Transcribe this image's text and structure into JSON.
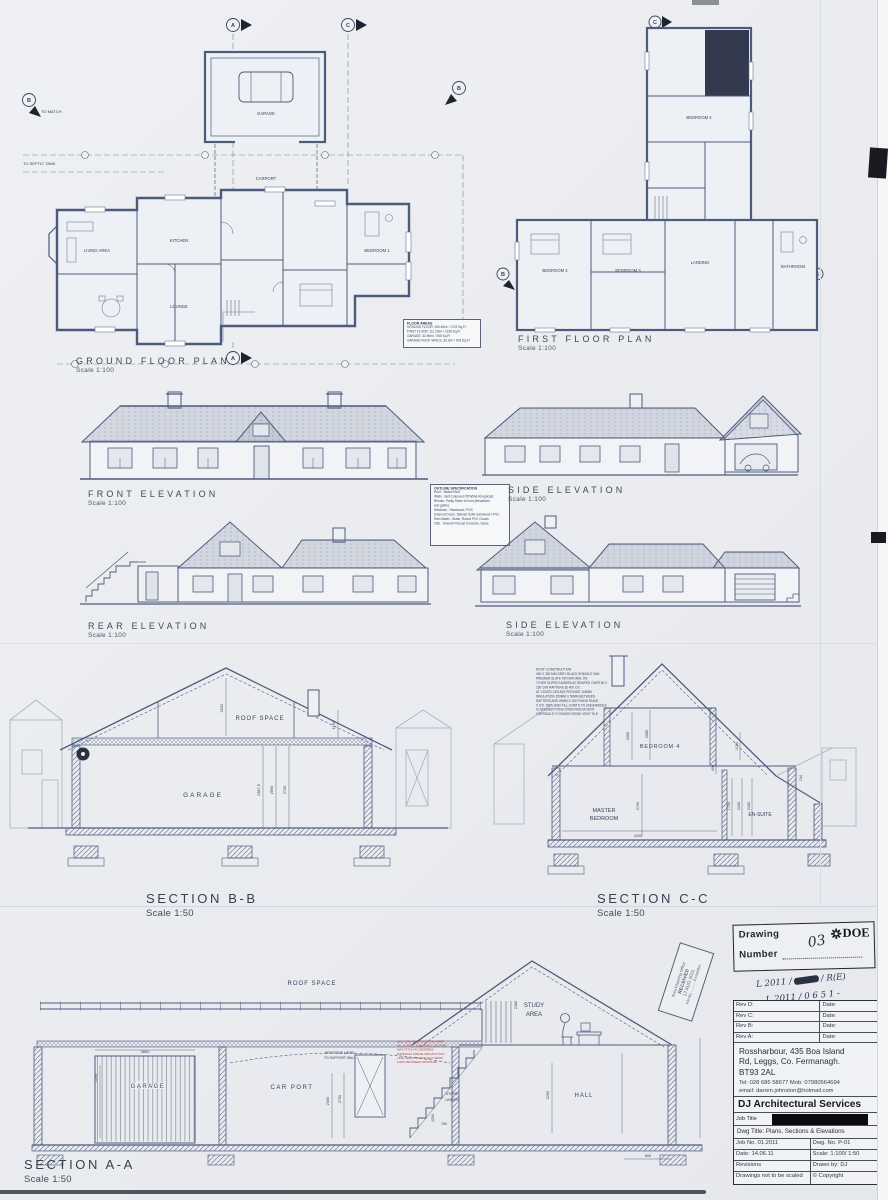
{
  "plans": {
    "ground": {
      "title": "GROUND FLOOR PLAN",
      "scale": "Scale 1:100",
      "labels": {
        "living": "LIVING AREA",
        "kitchen": "KITCHEN",
        "lounge": "LOUNGE",
        "bed1": "BEDROOM 1",
        "garage": "GARAGE",
        "carport": "CARPORT",
        "to_match": "TO MATCH",
        "to_septic": "TO SEPTIC TANK"
      },
      "markers": {
        "a": "A",
        "b": "B",
        "c": "C"
      }
    },
    "first": {
      "title": "FIRST FLOOR PLAN",
      "scale": "Scale 1:100",
      "labels": {
        "bed2": "BEDROOM 2",
        "bed3": "BEDROOM 3",
        "bed4": "BEDROOM 4",
        "bath": "BATHROOM",
        "landing": "LANDING"
      },
      "markers": {
        "b": "B",
        "c": "C"
      }
    },
    "floor_areas": {
      "title": "FLOOR AREAS",
      "lines": [
        "GROUND FLOOR: 160.49m² / 1722 Sq.Ft",
        "FIRST FLOOR: 111.29m² / 1198 Sq.Ft",
        "GARAGE: 32.96m² / 355 Sq.Ft",
        "GARAGE ROOF SPACE: 83.9m² / 903 Sq.Ft"
      ]
    }
  },
  "elevations": {
    "front": {
      "title": "FRONT ELEVATION",
      "scale": "Scale 1:100"
    },
    "side_right": {
      "title": "SIDE ELEVATION",
      "scale": "Scale 1:100"
    },
    "rear": {
      "title": "REAR ELEVATION",
      "scale": "Scale 1:100"
    },
    "side_left": {
      "title": "SIDE ELEVATION",
      "scale": "Scale 1:100"
    },
    "outline_spec": {
      "title": "OUTLINE SPECIFICATION",
      "lines": [
        "Roof  -  Slated Roof",
        "Walls - Self Coloured Off White Roughcast",
        "Render, Partly Stone to front (elevations",
        "and gable)",
        "Windows  -  Hardwood / PVC",
        "External Doors: Stained Solid Hardwood / PVC",
        "Rain Water  -  Black, Round PVC Goods",
        "Cills  -  Smooth Precast Concrete, Stone"
      ]
    }
  },
  "sections": {
    "bb": {
      "title": "SECTION B-B",
      "scale": "Scale 1:50",
      "roof_space": "ROOF SPACE",
      "garage": "GARAGE",
      "dims": [
        "2342",
        "1150",
        "2387.5",
        "2590",
        "2700"
      ]
    },
    "cc": {
      "title": "SECTION C-C",
      "scale": "Scale 1:50",
      "bedroom4": "BEDROOM 4",
      "master_l1": "MASTER",
      "master_l2": "BEDROOM",
      "ensuite": "EN-SUITE",
      "dims": [
        "2000",
        "2085",
        "1150",
        "400",
        "2700",
        "1750",
        "2200",
        "2400",
        "134",
        "4200"
      ]
    },
    "aa": {
      "title": "SECTION A-A",
      "scale": "Scale 1:50",
      "roof_space": "ROOF SPACE",
      "garage": "GARAGE",
      "carport": "CAR PORT",
      "hall": "HALL",
      "study_l1": "STUDY",
      "study_l2": "AREA",
      "store_l1": "STORE",
      "store_l2": "UNDER",
      "keystone_l1": "KEYSTONE LINTEL",
      "keystone_l2": "TO SUPPORT WALL",
      "dims": [
        "3800",
        "1100",
        "2300",
        "2700",
        "2460",
        "2200",
        "760",
        "1200",
        "600"
      ]
    },
    "roof_note": {
      "lines": [
        "ROOF CONSTRUCTION",
        "400 X 250 MM GREY BLACK SHINGLE OAK",
        "PREMIER SLATE OR NATURAL ON",
        "TYVEK SUPRO UNDERLAY DRAPED OVER 50 X",
        "150 C/W RAFTERS @ 400 C/C",
        "AT COVED CEILING PROVIDE 100MM",
        "INSULATION 150MM X 50MM BETWEEN",
        "RAFTERS AND 25MM X 150 FIXING RUNS",
        "X STL TAPE AND FILL JOINTS TO UNDERSIDES",
        "SLATES/BUTTONS OVER FASCIA VENT",
        "OVERSAILS 'G' RANGE RIDGE VENT TILE"
      ]
    },
    "stair_note": {
      "lines": [
        "MIN. CLR HEADROOM 2M OVER",
        "ALL STAIRS: 220 GOING, 200 RISE",
        "MAX PITCH 42 DEGREES",
        "HANDRAIL 900MM ABOVE PITCH",
        "LINE, BALUSTRADE MAX 99MM",
        "GAPS BETWEEN SPINDLES"
      ]
    }
  },
  "stamps": {
    "drawing_number": {
      "line1": "Drawing",
      "line2": "Number",
      "value": "03",
      "doe": "DOE"
    },
    "handwritten": {
      "l1a": "L 2011 /",
      "l1b": "/ R(E)",
      "l2": "L 2011 / 0 6 5 1 -"
    },
    "planning": {
      "l1": "Area Planning Office",
      "l2": "RECEIVED",
      "l3": "17 AUG 2011",
      "l4": "File No. .......... Enniskillen"
    }
  },
  "title_block": {
    "revs": [
      {
        "label": "Rev D:",
        "date": "Date:"
      },
      {
        "label": "Rev C:",
        "date": "Date:"
      },
      {
        "label": "Rev B:",
        "date": "Date:"
      },
      {
        "label": "Rev A:",
        "date": "Date:"
      }
    ],
    "address_line1": "Rossharbour, 435 Boa Island",
    "address_line2": "Rd, Leggs, Co. Fermanagh.",
    "address_line3": "BT93 2AL",
    "tel": "Tel: 028 686 58677  Mob: 07980564694",
    "email": "email: darren.johnston@hotmail.com",
    "company": "DJ Architectural Services",
    "job_title_label": "Job Title",
    "dwg_title": "Dwg Title:  Plans, Sections & Elevations",
    "job_no": "Job No. 01.2011",
    "dwg_no": "Dwg. No. P-01",
    "date": "Date: 14.06.11",
    "scale": "Scale: 1:100/ 1:50",
    "revisions": "Revisions",
    "drawn_by": "Drawn by: DJ",
    "no_scale": "Drawings not to be scaled",
    "copyright": "© Copyright"
  }
}
